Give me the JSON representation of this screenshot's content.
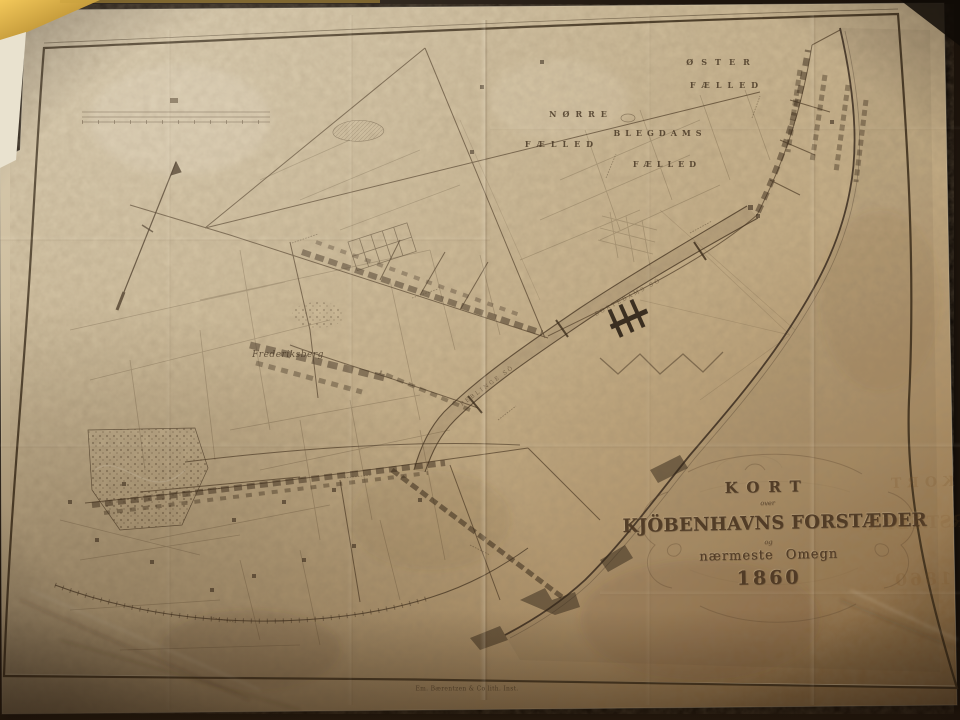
{
  "title_cartouche": {
    "kort": "KORT",
    "over": "over",
    "main": "KJÖBENHAVNS FORSTÆDER",
    "og": "og",
    "subtitle": "nærmeste Omegn",
    "year": "1860"
  },
  "region_labels": {
    "oster_1": "ØSTER",
    "oster_2": "FÆLLED",
    "norre_1": "NØRRE",
    "norre_2": "FÆLLED",
    "blegdams_1": "BLEGDAMS",
    "blegdams_2": "FÆLLED",
    "frederiksberg": "Frederiksberg"
  },
  "lake_labels": {
    "sortedams": "SORTEDAMS SÖ",
    "peblinge": "PEBLINGE SÖ"
  },
  "ghost_text": {
    "kort": "KORT",
    "main": "FORSTÆDER",
    "year": "1860"
  },
  "imprint": "Em. Bærentzen & Co lith. Inst.",
  "colors": {
    "paper": "#c8b694",
    "ink": "#4a3a26",
    "wall": "#1d140c",
    "frame_gold": "#d9a93c"
  }
}
